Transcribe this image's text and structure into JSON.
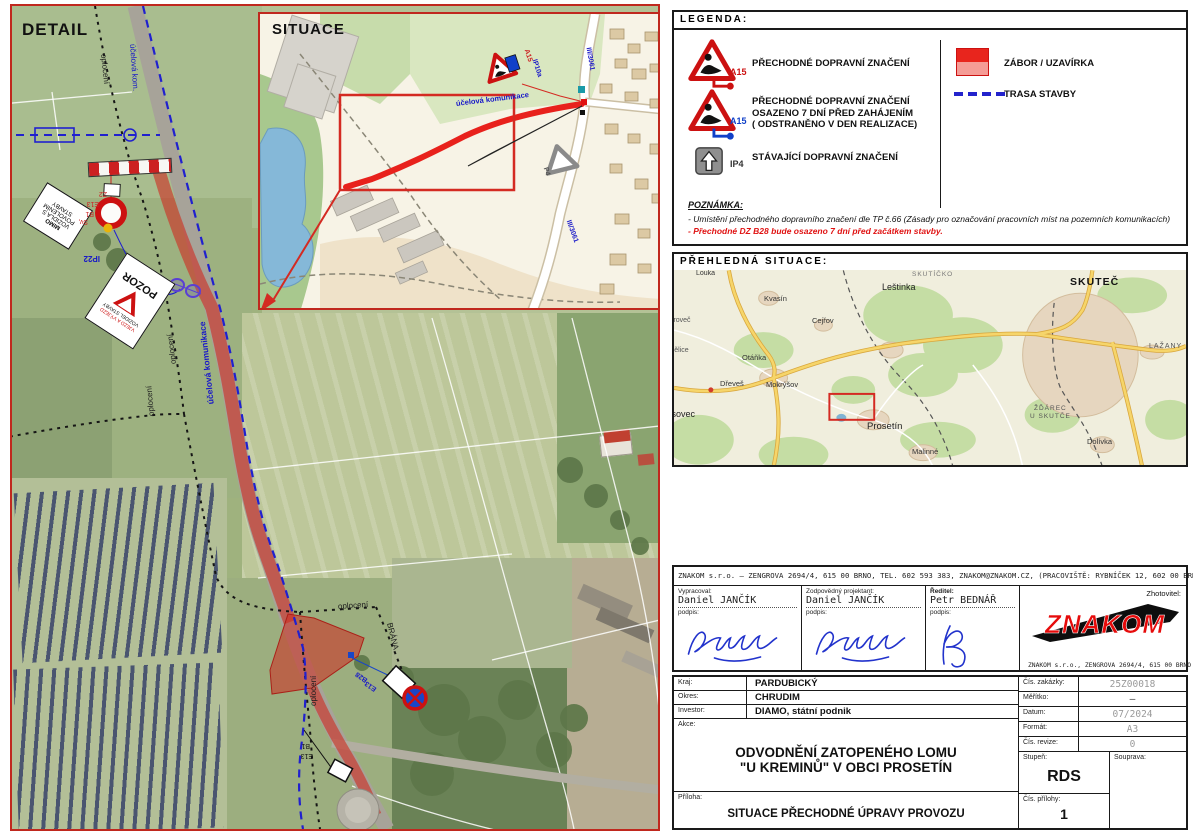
{
  "detail": {
    "title": "DETAIL",
    "labels": [
      {
        "t": "účelová kom.",
        "x": 120,
        "y": 22,
        "r": 86,
        "c": "#1818c8",
        "s": 8
      },
      {
        "t": "oplocení",
        "x": 91,
        "y": 32,
        "r": 84,
        "c": "#1d1d1d",
        "s": 8
      },
      {
        "t": "oplocení",
        "x": 162,
        "y": 342,
        "r": -97,
        "c": "#1d1d1d",
        "s": 8
      },
      {
        "t": "oplocení",
        "x": 140,
        "y": 394,
        "r": -95,
        "c": "#1d1d1d",
        "s": 8
      },
      {
        "t": "účelová komunikace",
        "x": 199,
        "y": 382,
        "r": -96,
        "c": "#1818c8",
        "s": 8.5,
        "w": 700
      },
      {
        "t": "oplocení",
        "x": 326,
        "y": 585,
        "r": -4,
        "c": "#1d1d1d",
        "s": 8
      },
      {
        "t": "BRÁNA",
        "x": 377,
        "y": 601,
        "r": 76,
        "c": "#1d1d1d",
        "s": 8
      },
      {
        "t": "oplocení",
        "x": 302,
        "y": 684,
        "r": -90,
        "c": "#1d1d1d",
        "s": 8
      },
      {
        "t": "Z2",
        "x": 95,
        "y": 172,
        "r": 180,
        "c": "#cc2222",
        "s": 7
      },
      {
        "t": "E13",
        "x": 87,
        "y": 182,
        "r": 180,
        "c": "#cc2222",
        "s": 7
      },
      {
        "t": "B1",
        "x": 82,
        "y": 192,
        "r": 180,
        "c": "#cc2222",
        "s": 7
      },
      {
        "t": "Sv,",
        "x": 76,
        "y": 200,
        "r": 180,
        "c": "#cc2222",
        "s": 7
      },
      {
        "t": "IP22",
        "x": 88,
        "y": 236,
        "r": 180,
        "c": "#1818c8",
        "s": 8,
        "w": 700
      },
      {
        "t": "B28",
        "x": 355,
        "y": 659,
        "r": 215,
        "c": "#1818c8",
        "s": 7,
        "w": 700
      },
      {
        "t": "E13",
        "x": 364,
        "y": 668,
        "r": 215,
        "c": "#1818c8",
        "s": 7,
        "w": 700
      },
      {
        "t": "B1",
        "x": 298,
        "y": 724,
        "r": 180,
        "c": "#111111",
        "s": 7
      },
      {
        "t": "E13",
        "x": 301,
        "y": 734,
        "r": 180,
        "c": "#111111",
        "s": 7
      }
    ],
    "pozor_sign": {
      "small_red": "VJEZD A VÝJEZD",
      "small_black": "VOZIDEL STAVBY",
      "main": "POZOR"
    },
    "mimo_sign": {
      "l1": "MIMO",
      "l2": "VOZIDLA S",
      "l3": "POVOLENÍM",
      "l4": "STAVBY"
    }
  },
  "situace": {
    "title": "SITUACE",
    "labels": [
      {
        "t": "A15",
        "x": 266,
        "y": 32,
        "r": 72,
        "c": "#cc2222",
        "s": 7,
        "w": 700
      },
      {
        "t": "IP10a",
        "x": 274,
        "y": 42,
        "r": 72,
        "c": "#1818c8",
        "s": 7,
        "w": 700
      },
      {
        "t": "III/3061",
        "x": 328,
        "y": 30,
        "r": 80,
        "c": "#1818c8",
        "s": 7,
        "w": 700
      },
      {
        "t": "III/3061",
        "x": 308,
        "y": 203,
        "r": 70,
        "c": "#1818c8",
        "s": 7,
        "w": 700
      },
      {
        "t": "účelová komunikace",
        "x": 196,
        "y": 86,
        "r": -7,
        "c": "#1818c8",
        "s": 7.5,
        "w": 700
      },
      {
        "t": "P4",
        "x": 285,
        "y": 150,
        "r": 72,
        "c": "#555555",
        "s": 7,
        "w": 700
      }
    ]
  },
  "legend": {
    "title": "LEGENDA:",
    "item1_code": "A15",
    "item1_text": "PŘECHODNÉ DOPRAVNÍ ZNAČENÍ",
    "item2_code": "A15",
    "item2_line1": "PŘECHODNÉ DOPRAVNÍ ZNAČENÍ",
    "item2_line2": "OSAZENO 7 DNÍ PŘED ZAHÁJENÍM",
    "item2_line3": "( ODSTRANĚNO V DEN REALIZACE)",
    "item3_code": "IP4",
    "item3_text": "STÁVAJÍCÍ DOPRAVNÍ ZNAČENÍ",
    "zabor_text": "ZÁBOR / UZAVÍRKA",
    "trasa_text": "TRASA STAVBY",
    "note_title": "POZNÁMKA:",
    "note_line1": "- Umístění přechodného dopravního značení dle TP č.66 (Zásady pro označování pracovních míst na pozemních komunikacích)",
    "note_line2": "- Přechodné DZ B28 bude osazeno 7 dní před začátkem stavby."
  },
  "overview": {
    "title": "PŘEHLEDNÁ SITUACE:",
    "places": [
      {
        "t": "Louka",
        "x": 22,
        "y": 0,
        "s": 7,
        "c": "#333333"
      },
      {
        "t": "SKUTÍČKO",
        "x": 238,
        "y": 2,
        "s": 6.5,
        "c": "#777777",
        "sp": 1
      },
      {
        "t": "Leštinka",
        "x": 208,
        "y": 13,
        "s": 9,
        "c": "#222222"
      },
      {
        "t": "SKUTEČ",
        "x": 396,
        "y": 7,
        "s": 10.5,
        "c": "#111111",
        "w": 700,
        "sp": 1
      },
      {
        "t": "LAŽANY",
        "x": 475,
        "y": 73,
        "s": 7,
        "c": "#555555",
        "sp": 1
      },
      {
        "t": "Kvasín",
        "x": 90,
        "y": 25,
        "s": 7.5,
        "c": "#333333"
      },
      {
        "t": "Cejřov",
        "x": 138,
        "y": 47,
        "s": 7.5,
        "c": "#333333"
      },
      {
        "t": "stroveč",
        "x": -6,
        "y": 47,
        "s": 7,
        "c": "#555555"
      },
      {
        "t": "rbělice",
        "x": -6,
        "y": 77,
        "s": 7,
        "c": "#555555"
      },
      {
        "t": "Otáňka",
        "x": 68,
        "y": 84,
        "s": 7.5,
        "c": "#333333"
      },
      {
        "t": "Dřeveš",
        "x": 46,
        "y": 110,
        "s": 7.5,
        "c": "#333333"
      },
      {
        "t": "Mokrýšov",
        "x": 92,
        "y": 111,
        "s": 7.5,
        "c": "#333333"
      },
      {
        "t": "ísovec",
        "x": -5,
        "y": 140,
        "s": 9,
        "c": "#222222"
      },
      {
        "t": "Prosetín",
        "x": 193,
        "y": 152,
        "s": 9.5,
        "c": "#222222"
      },
      {
        "t": "Malinné",
        "x": 238,
        "y": 178,
        "s": 7.5,
        "c": "#333333"
      },
      {
        "t": "ŽĎÁREC",
        "x": 360,
        "y": 136,
        "s": 6.5,
        "c": "#555555",
        "sp": 1
      },
      {
        "t": "U SKUTČE",
        "x": 356,
        "y": 144,
        "s": 6.5,
        "c": "#555555",
        "sp": 1
      },
      {
        "t": "Dolívka",
        "x": 413,
        "y": 168,
        "s": 7.5,
        "c": "#333333"
      }
    ]
  },
  "company": {
    "header": "ZNAKOM s.r.o. – ZENGROVA 2694/4, 615 00 BRNO, TEL. 602 593 383, ZNAKOM@ZNAKOM.CZ, (PRACOVIŠTĚ: RYBNÍČEK 12, 602 00 BRNO)",
    "col1_label": "Vypracoval:",
    "col1_name": "Daniel JANČÍK",
    "col2_label": "Zodpovědný projektant:",
    "col2_name": "Daniel JANČÍK",
    "col3_label": "Ředitel:",
    "col3_name": "Petr BEDNÁŘ",
    "podpis": "podpis:",
    "zhotovitel_label": "Zhotovitel:",
    "logo_text": "ZNAKOM",
    "logo_addr": "ZNAKOM  s.r.o.,  ZENGROVA 2694/4,  615 00 BRNO"
  },
  "titleblock": {
    "kraj_label": "Kraj:",
    "kraj": "PARDUBICKÝ",
    "okres_label": "Okres:",
    "okres": "CHRUDIM",
    "investor_label": "Investor:",
    "investor": "DIAMO,  státní  podnik",
    "akce_label": "Akce:",
    "akce_line1": "ODVODNĚNÍ ZATOPENÉHO LOMU",
    "akce_line2": "\"U KREMINŮ\" V OBCI PROSETÍN",
    "priloha_label": "Příloha:",
    "priloha": "SITUACE PŘECHODNÉ ÚPRAVY PROVOZU",
    "zakazka_label": "Čís. zakázky:",
    "zakazka": "25Z00018",
    "meritko_label": "Měřítko:",
    "meritko": "—",
    "datum_label": "Datum:",
    "datum": "07/2024",
    "format_label": "Formát:",
    "format": "A3",
    "revize_label": "Čís. revize:",
    "revize": "0",
    "stupen_label": "Stupeň:",
    "stupen": "RDS",
    "souprava_label": "Souprava:",
    "prilohy_label": "Čís. přílohy:",
    "prilohy": "1"
  }
}
